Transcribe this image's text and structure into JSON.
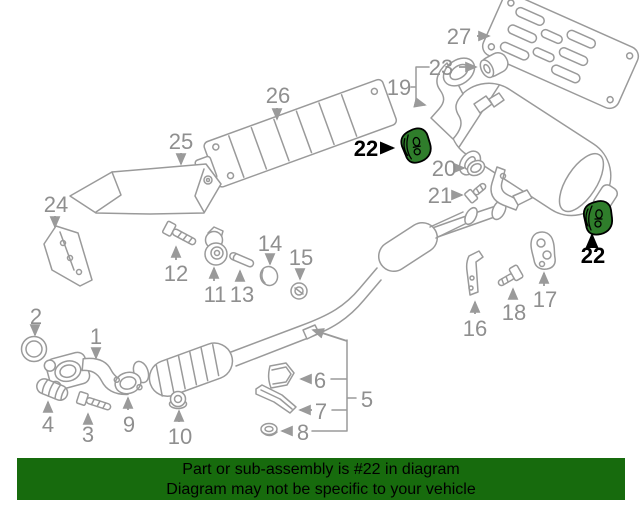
{
  "banner": {
    "line1": "Part or sub-assembly is #22 in diagram",
    "line2": "Diagram may not be specific to your vehicle",
    "background_color": "#176b0d",
    "text_color": "#000000"
  },
  "highlight": {
    "part_number": "22",
    "fill_color": "#2f7d2b",
    "outline_color": "#000000",
    "text_color": "#000000"
  },
  "diagram": {
    "type": "exploded-parts-diagram",
    "subject": "vehicle exhaust system",
    "background_color": "#ffffff",
    "line_color": "#9a9a9a",
    "label_color": "#8f8f8f",
    "callouts": [
      {
        "id": "1",
        "label": "1",
        "x": 96,
        "y": 344,
        "highlighted": false
      },
      {
        "id": "2",
        "label": "2",
        "x": 36,
        "y": 324,
        "highlighted": false
      },
      {
        "id": "3",
        "label": "3",
        "x": 88,
        "y": 442,
        "highlighted": false
      },
      {
        "id": "4",
        "label": "4",
        "x": 48,
        "y": 432,
        "highlighted": false
      },
      {
        "id": "5",
        "label": "5",
        "x": 367,
        "y": 407,
        "highlighted": false
      },
      {
        "id": "6",
        "label": "6",
        "x": 320,
        "y": 388,
        "highlighted": false
      },
      {
        "id": "7",
        "label": "7",
        "x": 321,
        "y": 419,
        "highlighted": false
      },
      {
        "id": "8",
        "label": "8",
        "x": 303,
        "y": 440,
        "highlighted": false
      },
      {
        "id": "9",
        "label": "9",
        "x": 129,
        "y": 432,
        "highlighted": false
      },
      {
        "id": "10",
        "label": "10",
        "x": 180,
        "y": 444,
        "highlighted": false
      },
      {
        "id": "11",
        "label": "11",
        "x": 215,
        "y": 302,
        "highlighted": false
      },
      {
        "id": "12",
        "label": "12",
        "x": 176,
        "y": 281,
        "highlighted": false
      },
      {
        "id": "13",
        "label": "13",
        "x": 242,
        "y": 302,
        "highlighted": false
      },
      {
        "id": "14",
        "label": "14",
        "x": 270,
        "y": 251,
        "highlighted": false
      },
      {
        "id": "15",
        "label": "15",
        "x": 301,
        "y": 265,
        "highlighted": false
      },
      {
        "id": "16",
        "label": "16",
        "x": 475,
        "y": 336,
        "highlighted": false
      },
      {
        "id": "17",
        "label": "17",
        "x": 545,
        "y": 307,
        "highlighted": false
      },
      {
        "id": "18",
        "label": "18",
        "x": 514,
        "y": 320,
        "highlighted": false
      },
      {
        "id": "19",
        "label": "19",
        "x": 399,
        "y": 95,
        "highlighted": false
      },
      {
        "id": "20",
        "label": "20",
        "x": 444,
        "y": 176,
        "highlighted": false
      },
      {
        "id": "21",
        "label": "21",
        "x": 440,
        "y": 203,
        "highlighted": false
      },
      {
        "id": "22-left",
        "label": "22",
        "x": 366,
        "y": 156,
        "highlighted": true
      },
      {
        "id": "22-right",
        "label": "22",
        "x": 593,
        "y": 263,
        "highlighted": true
      },
      {
        "id": "23",
        "label": "23",
        "x": 441,
        "y": 75,
        "highlighted": false
      },
      {
        "id": "24",
        "label": "24",
        "x": 56,
        "y": 212,
        "highlighted": false
      },
      {
        "id": "25",
        "label": "25",
        "x": 181,
        "y": 149,
        "highlighted": false
      },
      {
        "id": "26",
        "label": "26",
        "x": 278,
        "y": 103,
        "highlighted": false
      },
      {
        "id": "27",
        "label": "27",
        "x": 459,
        "y": 44,
        "highlighted": false
      }
    ]
  }
}
